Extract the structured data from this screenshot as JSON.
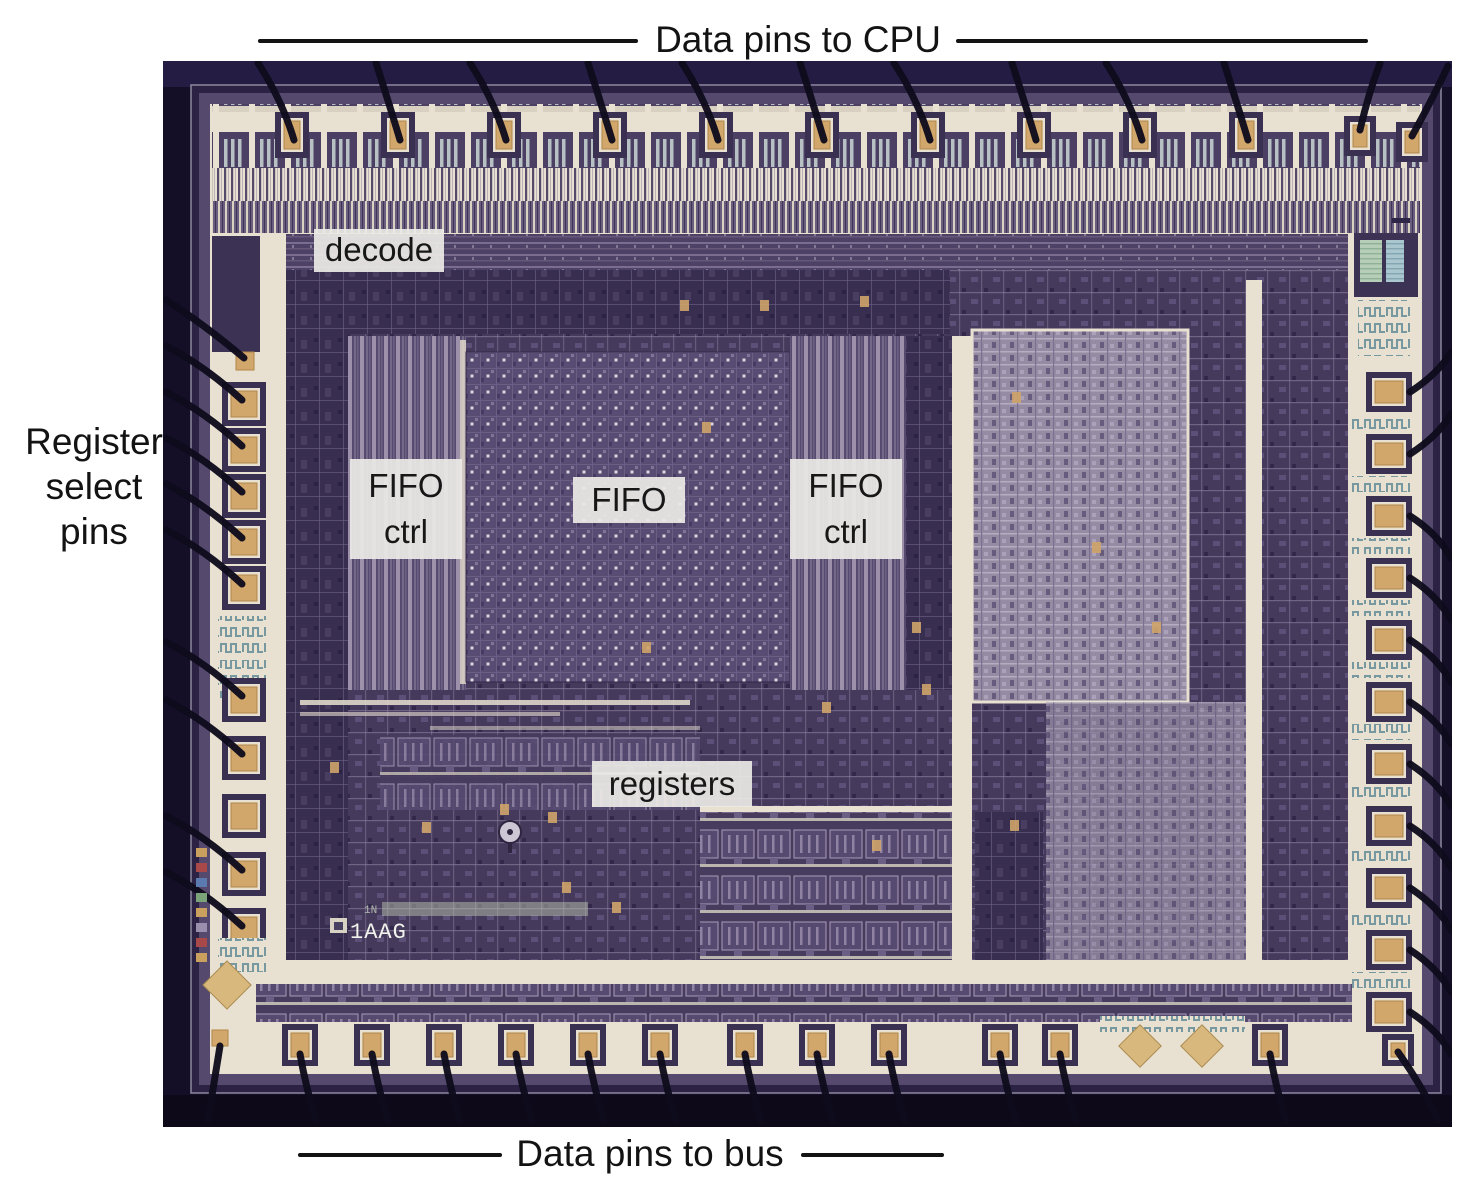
{
  "annotations": {
    "top": {
      "label": "Data pins to CPU"
    },
    "left": {
      "label": "Register\nselect\npins"
    },
    "bottom": {
      "label": "Data pins to bus"
    }
  },
  "die_labels": {
    "decode": "decode",
    "fifo_ctrl_left": "FIFO\nctrl",
    "fifo": "FIFO",
    "fifo_ctrl_right": "FIFO\nctrl",
    "registers": "registers"
  },
  "die_markings": {
    "code_small": "1N",
    "code_main": "1AAG"
  },
  "colors": {
    "page_bg": "#ffffff",
    "annotation_text": "#131313",
    "photo_bg": "#140e26",
    "die_base_purple": "#463a5c",
    "routing_cream": "#e8e0d0",
    "bond_pad_tan": "#d2a76b",
    "bond_wire": "#0f0b1c",
    "label_bg": "#ebe9e6",
    "label_text": "#171717"
  }
}
